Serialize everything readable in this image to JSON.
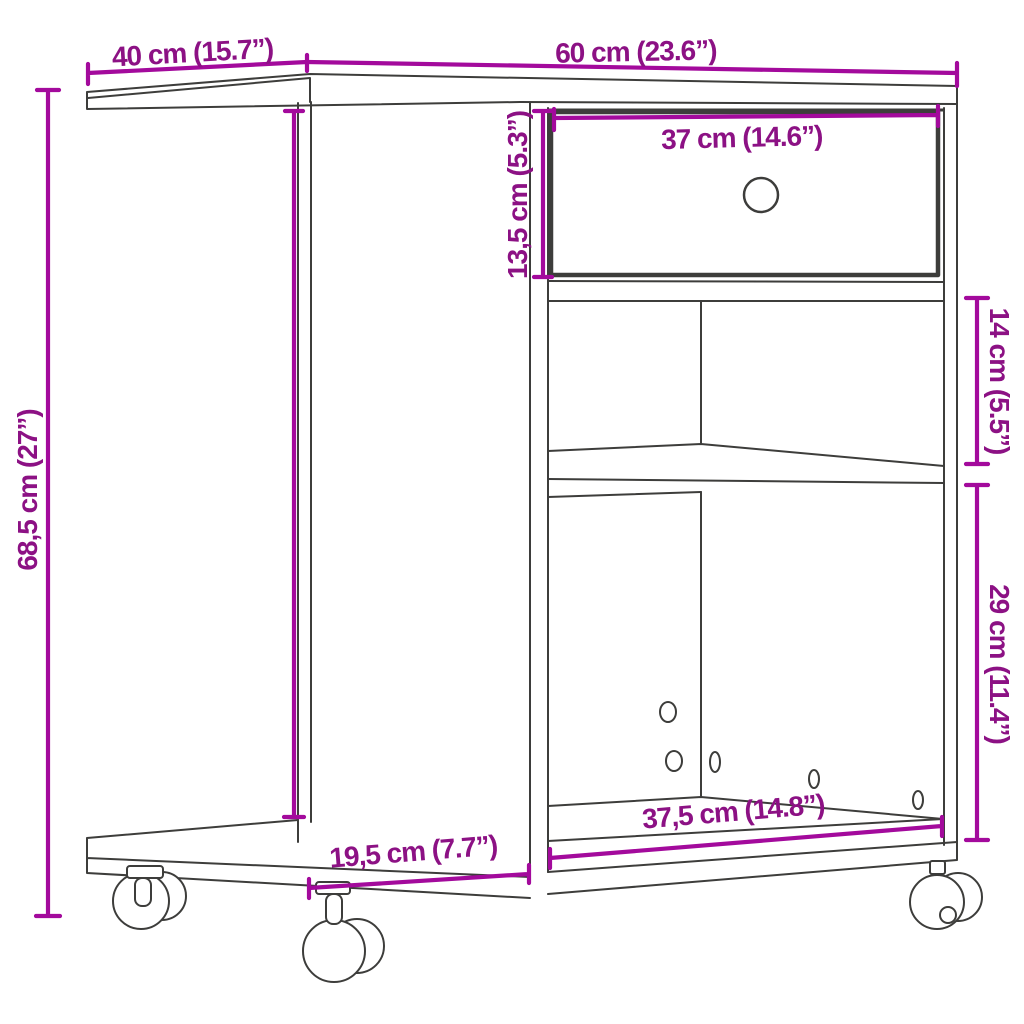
{
  "diagram": {
    "kind": "furniture-dimension-drawing",
    "subject": "rolling side table / printer stand with drawer, open shelf and casters"
  },
  "colors": {
    "accent_line": "#A30A9C",
    "accent_text": "#8C1184",
    "outline": "#3D3D3B",
    "background": "#FFFFFF"
  },
  "dimensions": {
    "top_depth": {
      "label": "40 cm (15.7”)",
      "value_cm": 40,
      "value_in": 15.7
    },
    "top_width": {
      "label": "60 cm (23.6”)",
      "value_cm": 60,
      "value_in": 23.6
    },
    "drawer_width": {
      "label": "37 cm (14.6”)",
      "value_cm": 37,
      "value_in": 14.6
    },
    "drawer_height": {
      "label": "13,5 cm (5.3”)",
      "value_cm": 13.5,
      "value_in": 5.3
    },
    "shelf_height": {
      "label": "14 cm (5.5”)",
      "value_cm": 14,
      "value_in": 5.5
    },
    "compartment_height": {
      "label": "29 cm (11.4”)",
      "value_cm": 29,
      "value_in": 11.4
    },
    "overall_height": {
      "label": "68,5 cm (27”)",
      "value_cm": 68.5,
      "value_in": 27
    },
    "base_depth": {
      "label": "19,5 cm (7.7”)",
      "value_cm": 19.5,
      "value_in": 7.7
    },
    "lower_width": {
      "label": "37,5 cm (14.8”)",
      "value_cm": 37.5,
      "value_in": 14.8
    }
  }
}
